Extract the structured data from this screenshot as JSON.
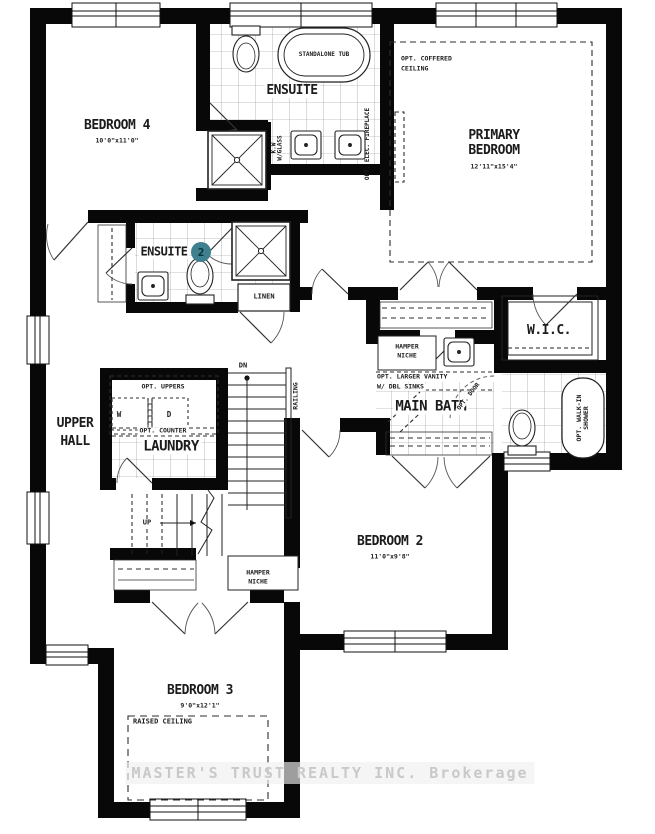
{
  "plan": {
    "rooms": {
      "bedroom4": {
        "name": "BEDROOM 4",
        "dims": "10'0\"x11'0\""
      },
      "ensuite": {
        "name": "ENSUITE"
      },
      "primary_bedroom": {
        "line1": "PRIMARY",
        "line2": "BEDROOM",
        "dims": "12'11\"x15'4\""
      },
      "ensuite2": {
        "name": "ENSUITE",
        "number": "2"
      },
      "wic": {
        "name": "W.I.C."
      },
      "main_bath": {
        "name": "MAIN BATH"
      },
      "upper_hall": {
        "line1": "UPPER",
        "line2": "HALL"
      },
      "laundry": {
        "name": "LAUNDRY"
      },
      "bedroom2": {
        "name": "BEDROOM 2",
        "dims": "11'0\"x9'8\""
      },
      "bedroom3": {
        "name": "BEDROOM 3",
        "dims": "9'0\"x12'1\""
      }
    },
    "features": {
      "standalone_tub": "STANDALONE TUB",
      "coffered_l1": "OPT. COFFERED",
      "coffered_l2": "CEILING",
      "fireplace": "OPT. ELEC. FIREPLACE",
      "kw_l1": "K.W",
      "kw_l2": "W/GLASS",
      "linen": "LINEN",
      "hamper1_l1": "HAMPER",
      "hamper1_l2": "NICHE",
      "vanity_l1": "OPT.  LARGER VANITY",
      "vanity_l2": "W/ DBL SINKS",
      "opt_door": "OPT. DOOR",
      "walkin_l1": "OPT. WALK-IN",
      "walkin_l2": "SHOWER",
      "opt_uppers": "OPT. UPPERS",
      "washer": "W",
      "dryer": "D",
      "opt_counter": "OPT. COUNTER",
      "raised_ceiling": "RAISED CEILING",
      "hamper2_l1": "HAMPER",
      "hamper2_l2": "NICHE"
    },
    "stairs": {
      "dn": "DN",
      "up": "UP",
      "railing": "RAILING"
    },
    "colors": {
      "wall": "#080808",
      "accent_circle": "#3f808f",
      "watermark": "#c9c9c9"
    },
    "watermark": "MASTER'S TRUST REALTY INC. Brokerage"
  }
}
